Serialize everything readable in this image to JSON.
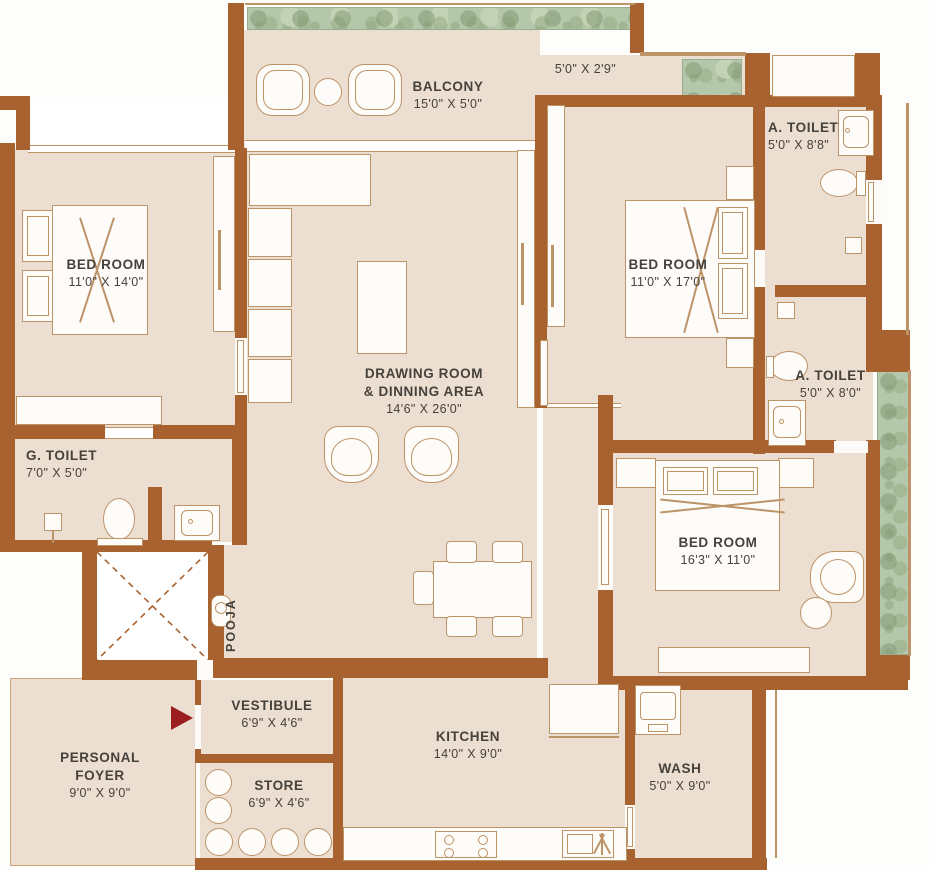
{
  "title": "3 BHK Apartment Floor Plan",
  "colors": {
    "wall": "#a8622f",
    "floor": "#ecdfd2",
    "planter": "#b5c7ab",
    "furniture_outline": "#bd9368",
    "text": "#46413b",
    "entry_arrow": "#9b1d1d"
  },
  "rooms": {
    "balcony": {
      "name": "BALCONY",
      "dims": "15'0\" X 5'0\""
    },
    "side_balcony": {
      "dims": "5'0\" X 2'9\""
    },
    "bedroom_left": {
      "name": "BED ROOM",
      "dims": "11'0\" X 14'0\""
    },
    "bedroom_right": {
      "name": "BED ROOM",
      "dims": "11'0\" X 17'0\""
    },
    "bedroom_bottom": {
      "name": "BED ROOM",
      "dims": "16'3\" X 11'0\""
    },
    "attached_toilet_top": {
      "name": "A. TOILET",
      "dims": "5'0\" X 8'8\""
    },
    "attached_toilet_mid": {
      "name": "A. TOILET",
      "dims": "5'0\" X 8'0\""
    },
    "guest_toilet": {
      "name": "G. TOILET",
      "dims": "7'0\" X 5'0\""
    },
    "drawing_room": {
      "name_line1": "DRAWING ROOM",
      "name_line2": "& DINNING AREA",
      "dims": "14'6\" X 26'0\""
    },
    "kitchen": {
      "name": "KITCHEN",
      "dims": "14'0\" X 9'0\""
    },
    "wash": {
      "name": "WASH",
      "dims": "5'0\" X 9'0\""
    },
    "store": {
      "name": "STORE",
      "dims": "6'9\" X 4'6\""
    },
    "vestibule": {
      "name": "VESTIBULE",
      "dims": "6'9\" X 4'6\""
    },
    "personal_foyer": {
      "name_line1": "PERSONAL",
      "name_line2": "FOYER",
      "dims": "9'0\" X 9'0\""
    },
    "pooja": {
      "name": "POOJA"
    }
  }
}
